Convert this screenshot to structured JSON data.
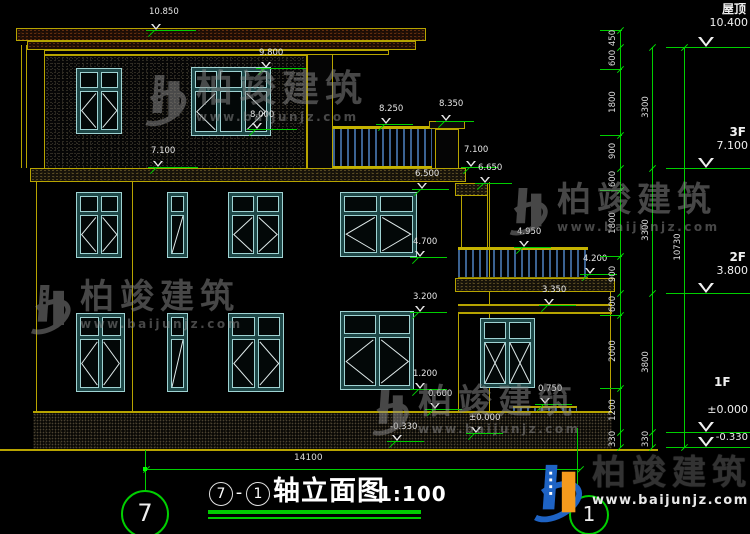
{
  "title": {
    "axis_start": "7",
    "separator": "-",
    "axis_end": "1",
    "name": "轴立面图",
    "scale": "1:100"
  },
  "watermark": {
    "cn": "柏竣建筑",
    "url": "www.baijunjz.com"
  },
  "axes": {
    "left_bubble": "7",
    "right_bubble": "1"
  },
  "dims": {
    "bottom_width": "14100",
    "inner": [
      "450",
      "600",
      "1800",
      "900",
      "600",
      "1800",
      "900",
      "600",
      "2000",
      "1200",
      "330"
    ],
    "mid": [
      "3300",
      "3300",
      "3800",
      "330"
    ],
    "total": "10730"
  },
  "levels": {
    "roof_label": "屋顶",
    "roof_value": "10.400",
    "f3_label": "3F",
    "f3_value": "7.100",
    "f2_label": "2F",
    "f2_value": "3.800",
    "f1_label": "1F",
    "f1_zero": "±0.000",
    "f1_minus": "-0.330"
  },
  "markers": [
    "10.850",
    "9.800",
    "8.000",
    "7.100",
    "8.250",
    "8.350",
    "7.100",
    "6.650",
    "6.500",
    "4.950",
    "4.700",
    "4.200",
    "3.350",
    "3.200",
    "1.200",
    "0.600",
    "0.750",
    "±0.000",
    "-0.330"
  ]
}
